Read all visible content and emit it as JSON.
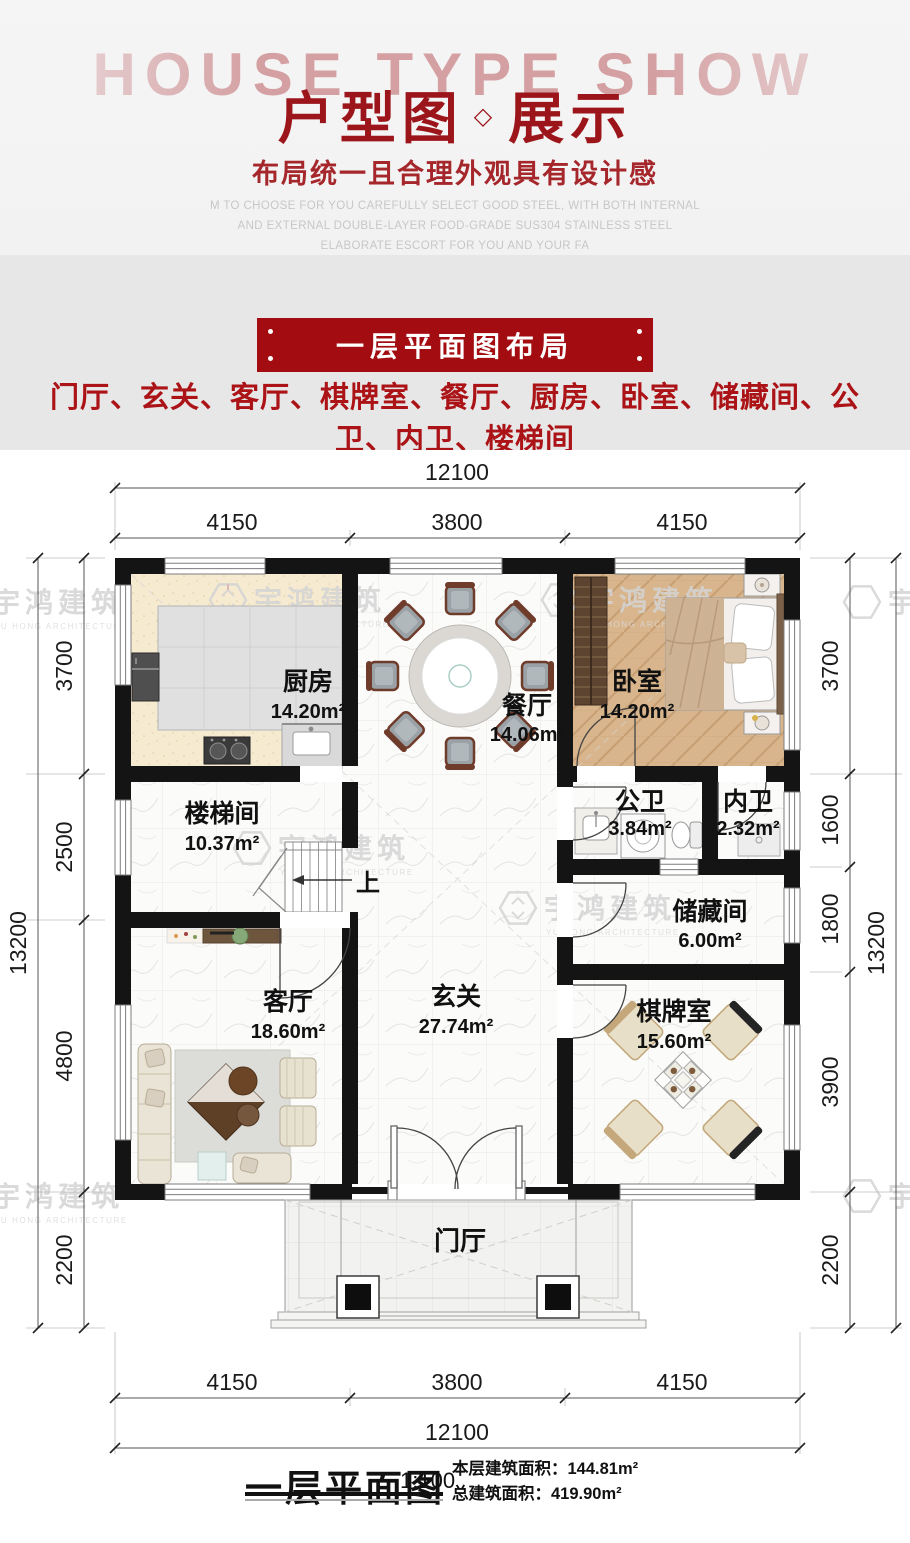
{
  "colors": {
    "brand_red": "#9b151a",
    "banner_red": "#a30d11",
    "list_red": "#ab1317"
  },
  "header": {
    "watermark": "HOUSE TYPE SHOW",
    "title_left": "户型图",
    "title_diamond": "◇",
    "title_right": "展示",
    "subtitle": "布局统一且合理外观具有设计感",
    "desc_line1": "M TO CHOOSE FOR YOU CAREFULLY SELECT GOOD STEEL, WITH BOTH INTERNAL",
    "desc_line2": "AND EXTERNAL DOUBLE-LAYER FOOD-GRADE SUS304 STAINLESS STEEL",
    "desc_line3": "ELABORATE ESCORT FOR YOU AND YOUR FA"
  },
  "section": {
    "banner": "一层平面图布局",
    "room_list": "门厅、玄关、客厅、棋牌室、餐厅、厨房、卧室、储藏间、公卫、内卫、楼梯间"
  },
  "plan": {
    "watermark_cn": "宇鸿建筑",
    "watermark_en": "YU HONG ARCHITECTURE",
    "up_label": "上",
    "rooms": {
      "kitchen": {
        "name": "厨房",
        "area": "14.20m²"
      },
      "dining": {
        "name": "餐厅",
        "area": "14.06m²"
      },
      "bedroom": {
        "name": "卧室",
        "area": "14.20m²"
      },
      "stairwell": {
        "name": "楼梯间",
        "area": "10.37m²"
      },
      "public_bath": {
        "name": "公卫",
        "area": "3.84m²"
      },
      "private_bath": {
        "name": "内卫",
        "area": "2.32m²"
      },
      "storage": {
        "name": "储藏间",
        "area": "6.00m²"
      },
      "living": {
        "name": "客厅",
        "area": "18.60m²"
      },
      "foyer": {
        "name": "玄关",
        "area": "27.74m²"
      },
      "mahjong": {
        "name": "棋牌室",
        "area": "15.60m²"
      },
      "porch": {
        "name": "门厅"
      }
    },
    "dims": {
      "top_total": "12100",
      "top_a": "4150",
      "top_b": "3800",
      "top_c": "4150",
      "bottom_a": "4150",
      "bottom_b": "3800",
      "bottom_c": "4150",
      "bottom_total": "12100",
      "left_total": "13200",
      "left_a": "3700",
      "left_b": "2500",
      "left_c": "4800",
      "left_d": "2200",
      "right_total": "13200",
      "right_a": "3700",
      "right_b": "1600",
      "right_c": "1800",
      "right_d": "3900",
      "right_e": "2200"
    }
  },
  "footer": {
    "title": "一层平面图",
    "scale": "1:100",
    "floor_area_label": "本层建筑面积：",
    "floor_area_value": "144.81m²",
    "total_area_label": "总建筑面积：",
    "total_area_value": "419.90m²"
  }
}
